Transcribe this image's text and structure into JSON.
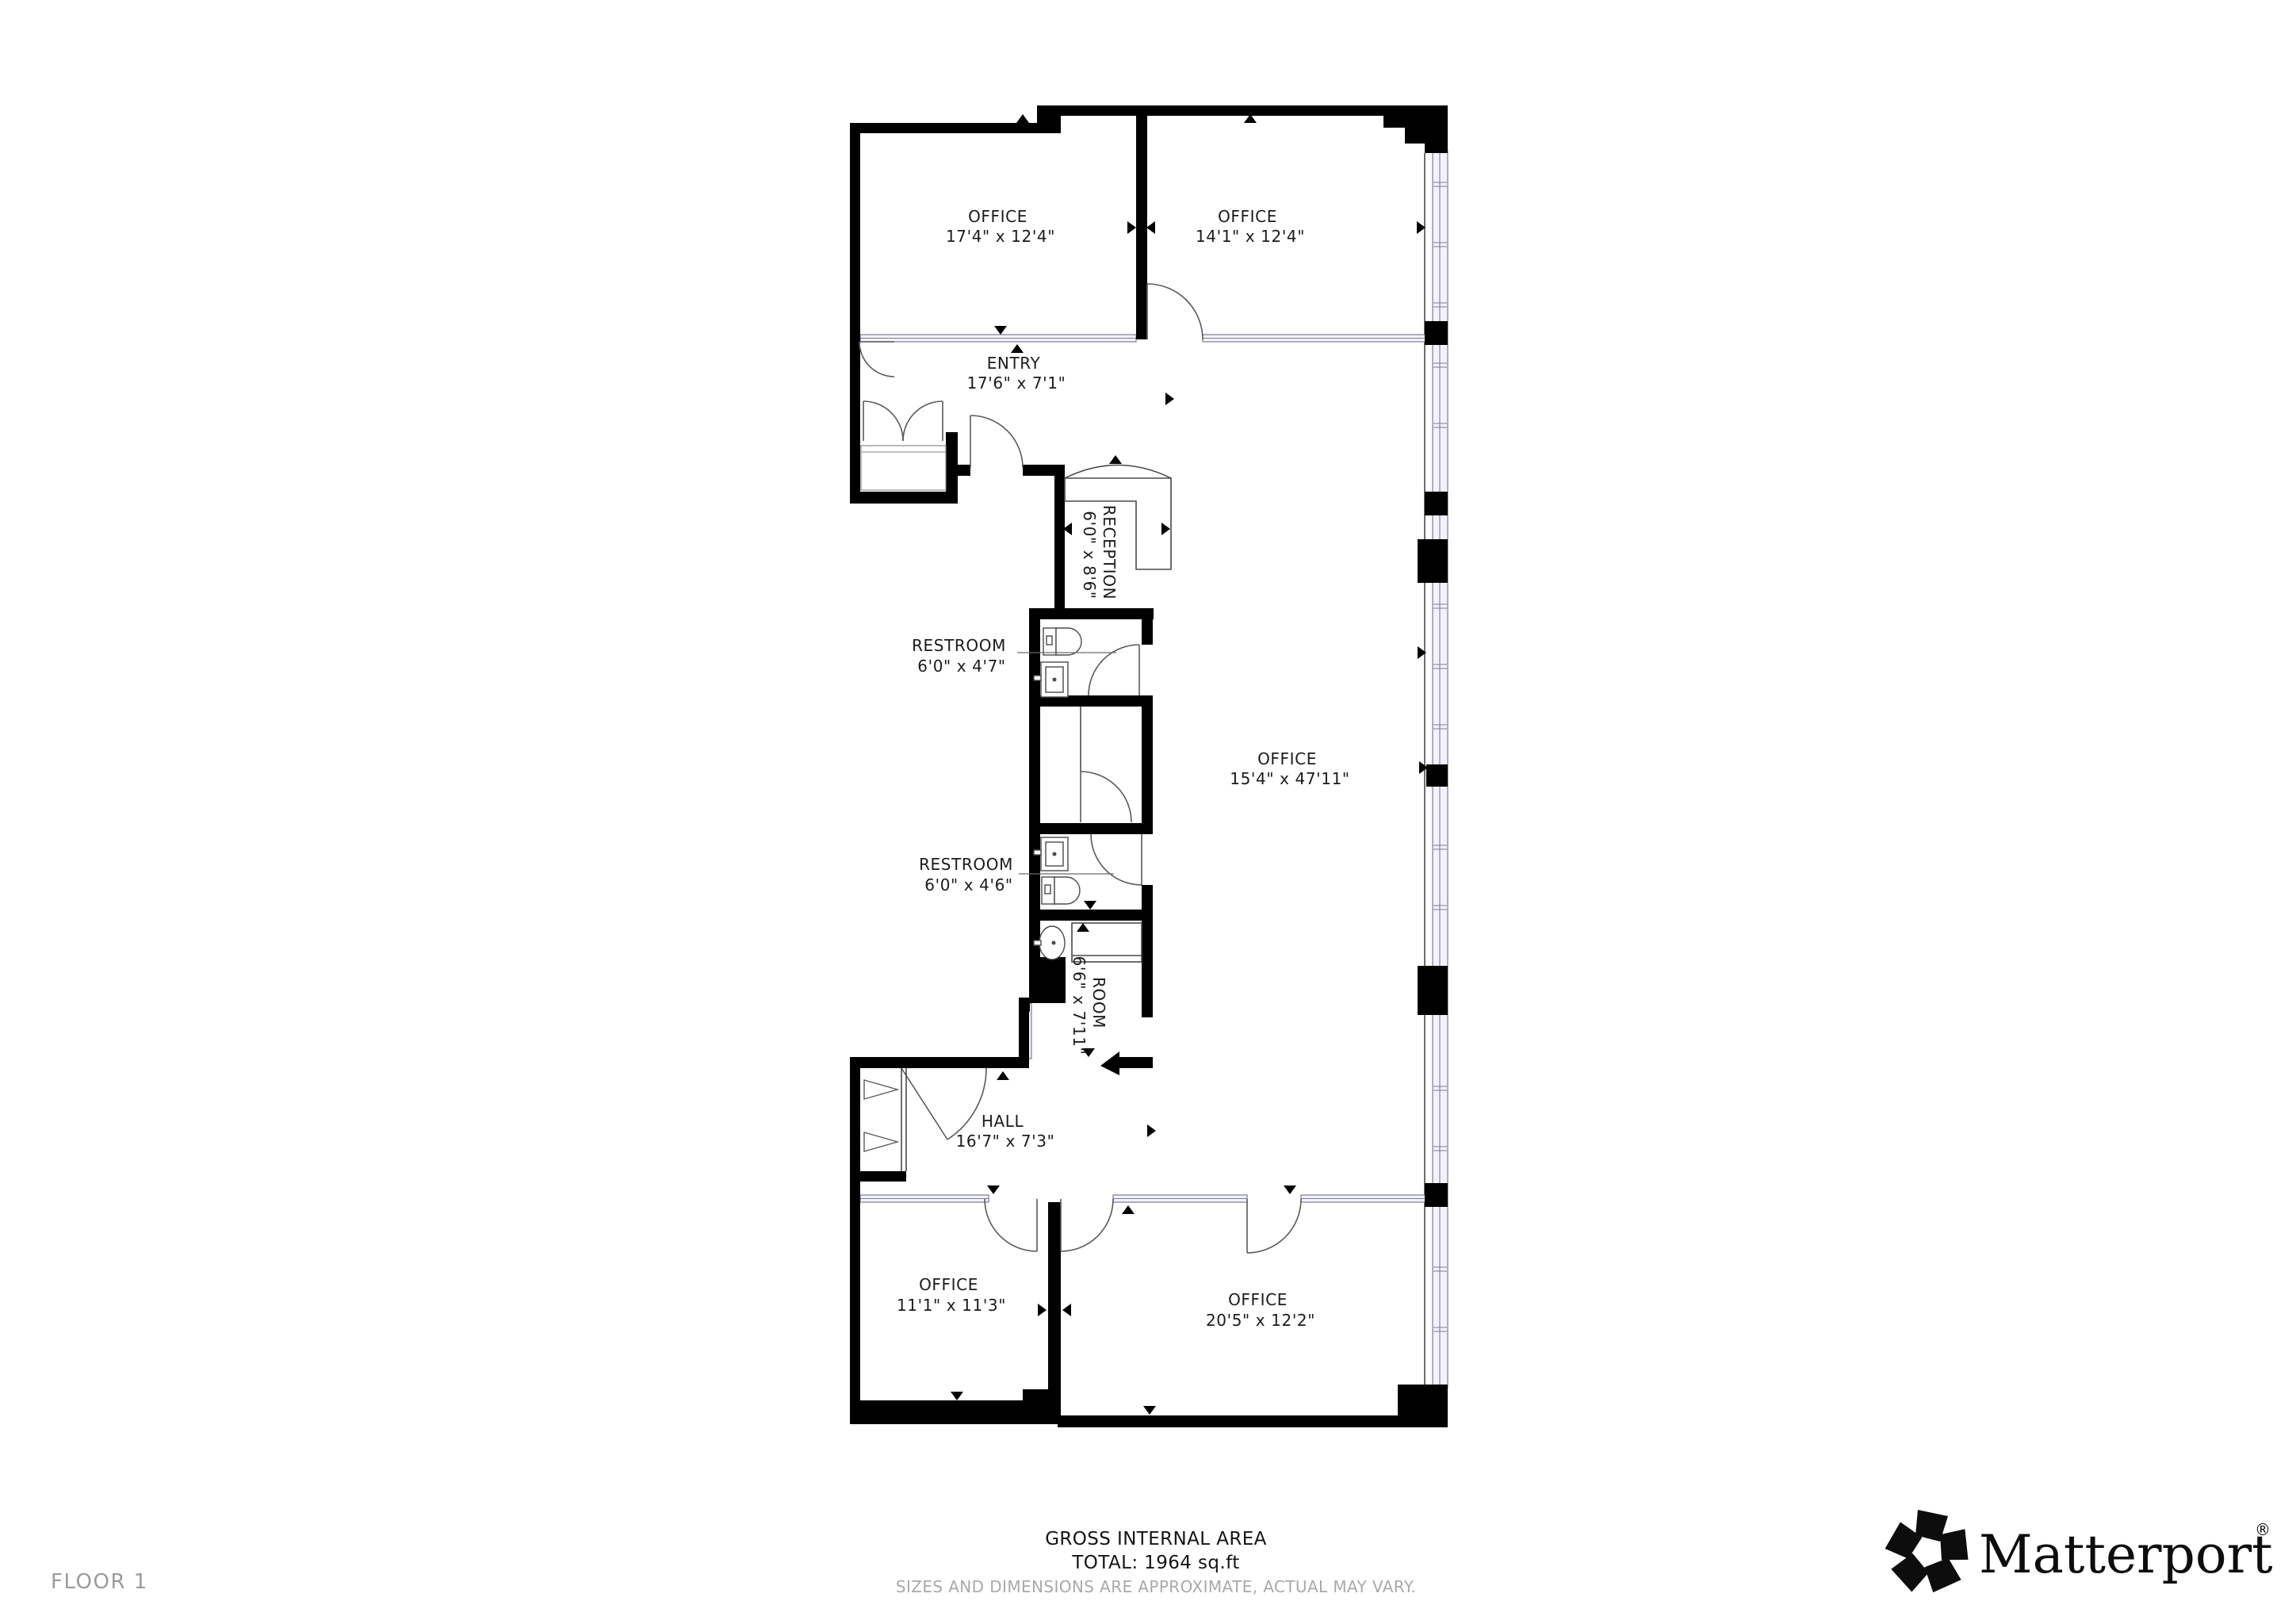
{
  "page": {
    "floor_label": "FLOOR 1"
  },
  "rooms": [
    {
      "id": "office-top-left",
      "name": "OFFICE",
      "dims": "17'4\" x 12'4\""
    },
    {
      "id": "office-top-right",
      "name": "OFFICE",
      "dims": "14'1\" x 12'4\""
    },
    {
      "id": "entry",
      "name": "ENTRY",
      "dims": "17'6\" x 7'1\""
    },
    {
      "id": "reception",
      "name": "RECEPTION",
      "dims": "6'0\" x 8'6\""
    },
    {
      "id": "restroom-upper",
      "name": "RESTROOM",
      "dims": "6'0\" x 4'7\""
    },
    {
      "id": "office-main",
      "name": "OFFICE",
      "dims": "15'4\" x 47'11\""
    },
    {
      "id": "restroom-lower",
      "name": "RESTROOM",
      "dims": "6'0\" x 4'6\""
    },
    {
      "id": "room-utility",
      "name": "ROOM",
      "dims": "6'6\" x 7'11\""
    },
    {
      "id": "hall",
      "name": "HALL",
      "dims": "16'7\" x 7'3\""
    },
    {
      "id": "office-bottom-left",
      "name": "OFFICE",
      "dims": "11'1\" x 11'3\""
    },
    {
      "id": "office-bottom-right",
      "name": "OFFICE",
      "dims": "20'5\" x 12'2\""
    }
  ],
  "footer": {
    "title": "GROSS INTERNAL AREA",
    "total": "TOTAL: 1964 sq.ft",
    "disclaimer": "SIZES AND DIMENSIONS ARE APPROXIMATE, ACTUAL MAY VARY."
  },
  "brand": {
    "wordmark": "Matterport",
    "registered": "®",
    "icon": "matterport-pinwheel-icon"
  },
  "colors": {
    "wall": "#000000",
    "glass_fill": "#f2f2fa",
    "glass_stroke": "#7d7d96",
    "line": "#4a4a4a",
    "text": "#1b1b1b",
    "muted_text": "#a9a9a9",
    "floor_label_text": "#9b9b9b",
    "background": "#ffffff"
  }
}
